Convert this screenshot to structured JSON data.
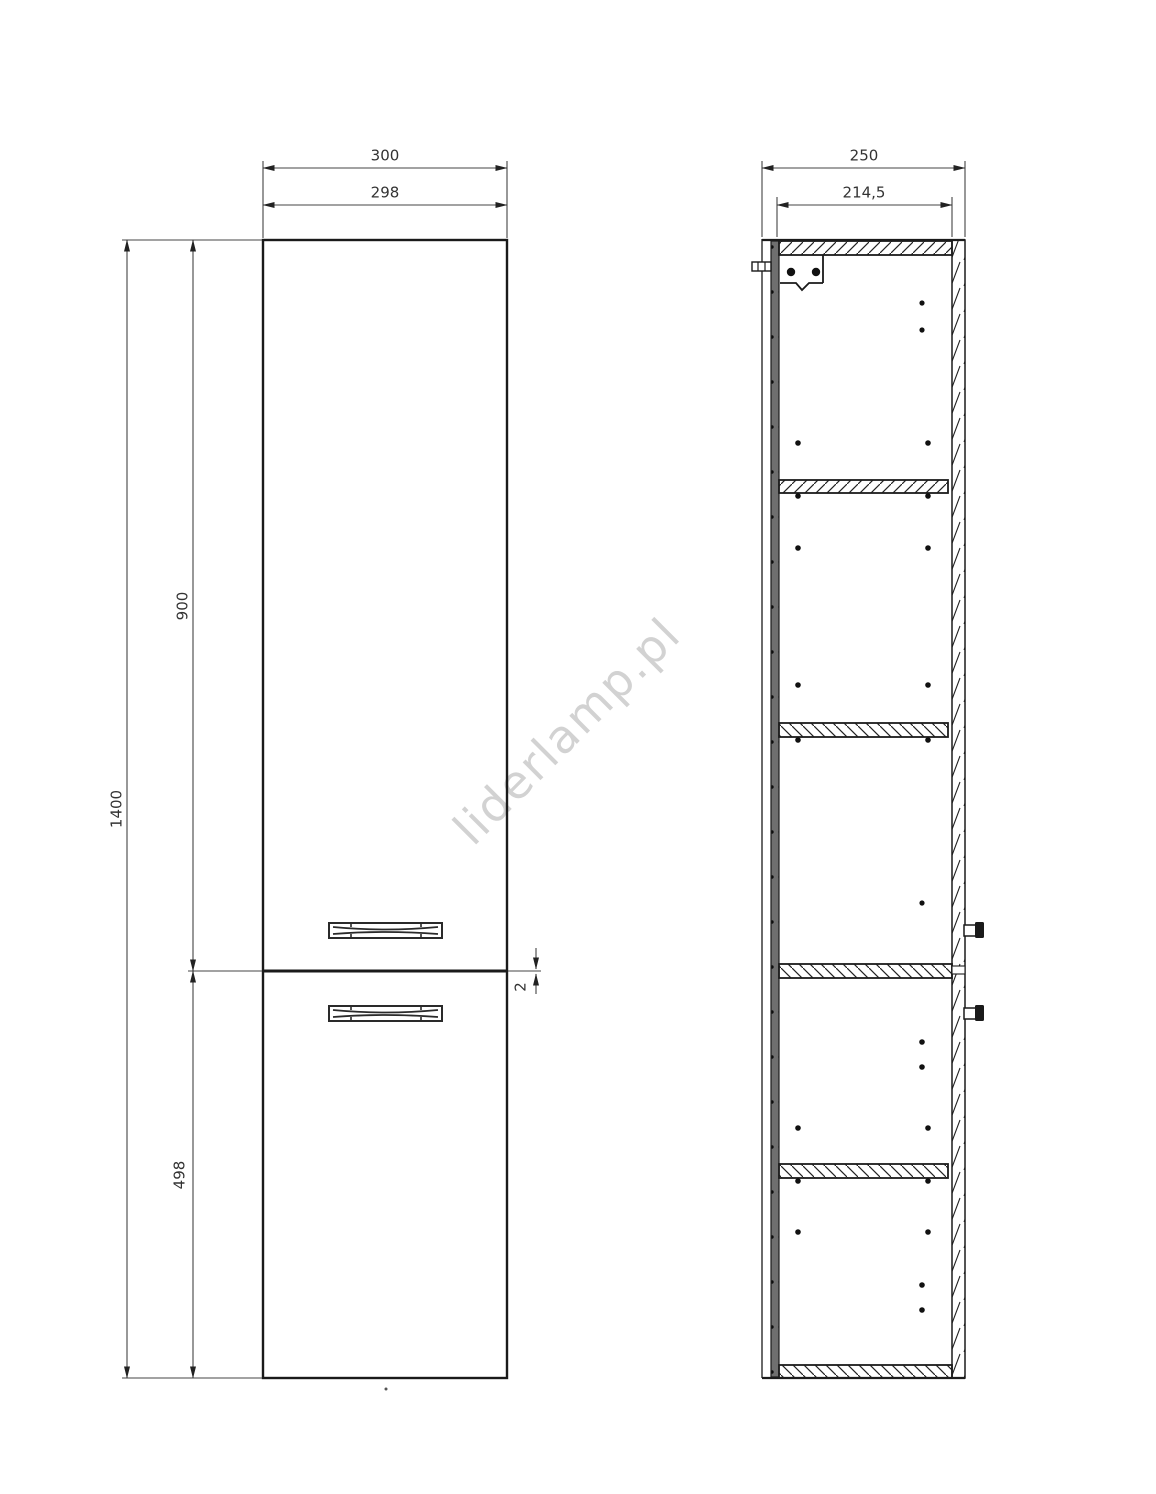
{
  "watermark": {
    "text": "liderlamp.pl"
  },
  "front_view": {
    "width_outer": "300",
    "width_door": "298",
    "height_total": "1400",
    "door_top_height": "900",
    "door_bottom_height": "498",
    "door_gap": "2"
  },
  "side_view": {
    "depth_outer": "250",
    "depth_inner": "214,5"
  }
}
